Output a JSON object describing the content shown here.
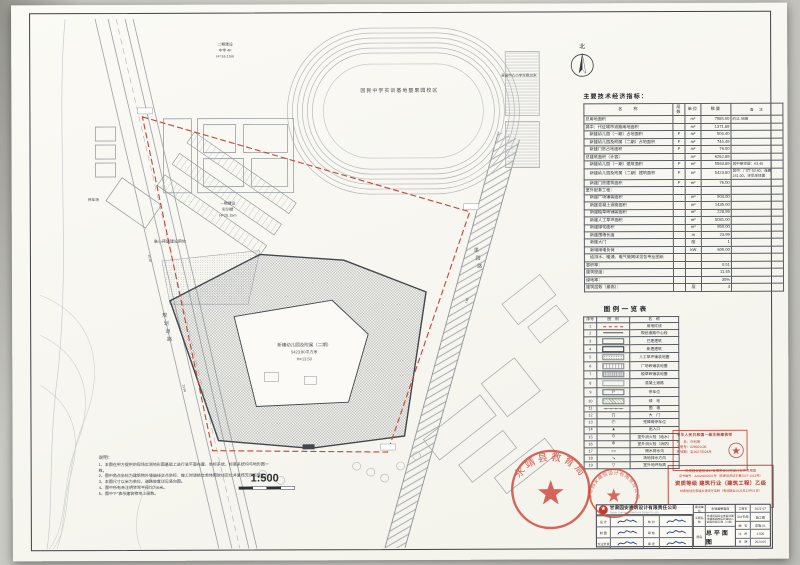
{
  "plan": {
    "north": "北",
    "scale": "1:500",
    "track_label": "回民中学实训基地暨果园校区",
    "school_note": "景园中心小学东侧20米",
    "phase_top": [
      "二期建设",
      "中学 4F",
      "H=16.15m"
    ],
    "phase_left": [
      "一期建设",
      "实训楼",
      "H=20.15m"
    ],
    "reserved": "高小预留建设用地",
    "parking_label": "停车场",
    "road_left": "规划道路",
    "road_right": "果园路",
    "building_label": [
      "新建幼儿园及附属（二期）",
      "5423.80平方米",
      "H=13.50"
    ],
    "dims": [
      "15.00",
      "23.99",
      "7.00"
    ],
    "notes_title": "说明：",
    "notes": [
      "本图在甲方提供的现场实测地形图基础上进行总平面布置，坐标系统、标高系统均与地形图一致。",
      "图中角点坐标为建筑物外墙轴线交点坐标，施工时请结合单体图放线定位并复核无误后施工。",
      "本图尺寸以米为单位，道路坡度详见竖向图。",
      "图中所有未注明转弯半径均为6米。",
      "图中\"F\"表示建筑物地上层数。"
    ]
  },
  "indicators": {
    "title": "主要技术经济指标：",
    "headers": [
      "名　　称",
      "层数",
      "单位",
      "数量",
      "备　注"
    ],
    "rows": [
      [
        "总用地面积",
        "",
        "m²",
        "7985.00",
        "约11.98亩"
      ],
      [
        "其中：代征城市道路用地面积",
        "",
        "m²",
        "1371.89",
        ""
      ],
      [
        "　新建幼儿园（一期）占地面积",
        "F",
        "m²",
        "504.40",
        ""
      ],
      [
        "　新建幼儿园及附属（二期）占地面积",
        "F",
        "m²",
        "744.49",
        ""
      ],
      [
        "　新建门房占地面积",
        "F",
        "m²",
        "76.00",
        ""
      ],
      [
        "总建筑面积（计容）",
        "",
        "m²",
        "6262.89",
        ""
      ],
      [
        "　新建幼儿园（一期）建筑面积",
        "F",
        "m²",
        "5563.89",
        "其中架空层：63.40"
      ],
      [
        "　新建幼儿园及附属（二期）建筑面积",
        "F",
        "m²",
        "5423.80",
        "其中：门厅 63.40、连廊 241.00，详见单体图"
      ],
      [
        "　新建门房建筑面积",
        "F",
        "m²",
        "76.00",
        ""
      ],
      [
        "室外配套工程：",
        "",
        "",
        "",
        ""
      ],
      [
        "　新建广场铺装面积",
        "",
        "m²",
        "904.00",
        ""
      ],
      [
        "　新建混凝土道路面积",
        "",
        "m²",
        "1435.00",
        ""
      ],
      [
        "　新建植草砖铺装面积",
        "",
        "m²",
        "228.99",
        ""
      ],
      [
        "　新建人工草坪面积",
        "",
        "m²",
        "5081.00",
        ""
      ],
      [
        "　新建绿化面积",
        "",
        "m²",
        "950.00",
        ""
      ],
      [
        "　新建围墙长度",
        "",
        "m",
        "23.99",
        ""
      ],
      [
        "　新建大门",
        "",
        "座",
        "1",
        ""
      ],
      [
        "　新增用电负荷",
        "",
        "kW",
        "600.00",
        ""
      ],
      [
        "　给排水、暖通、电气管网详见各专业图纸",
        "",
        "",
        "",
        ""
      ],
      [
        "容积率：",
        "",
        "",
        "0.51",
        ""
      ],
      [
        "建筑密度：",
        "",
        "",
        "11.45",
        ""
      ],
      [
        "绿地率：",
        "",
        "",
        "35%",
        ""
      ],
      [
        "建筑层数（最高）：",
        "",
        "层",
        "4",
        ""
      ]
    ]
  },
  "legend": {
    "title": "图例一览表",
    "headers": [
      "序号",
      "图　例",
      "名　称"
    ],
    "rows": [
      {
        "no": "1",
        "sym": "redline",
        "glyph": "",
        "name": "用地红线"
      },
      {
        "no": "2",
        "sym": "centerline",
        "glyph": "",
        "name": "规划道路中心线"
      },
      {
        "no": "3",
        "sym": "rect",
        "glyph": "",
        "name": "已建建筑"
      },
      {
        "no": "4",
        "sym": "rectbold",
        "glyph": "",
        "name": "新建建筑"
      },
      {
        "no": "5",
        "sym": "dots",
        "glyph": "",
        "name": "人工草坪铺装地面"
      },
      {
        "no": "6",
        "sym": "grid",
        "glyph": "",
        "name": "广场砖铺装地面"
      },
      {
        "no": "7",
        "sym": "gridg",
        "glyph": "",
        "name": "植草砖铺装地面"
      },
      {
        "no": "8",
        "sym": "plainrect",
        "glyph": "",
        "name": "混凝土道路"
      },
      {
        "no": "9",
        "sym": "prect",
        "glyph": "P",
        "name": "停车位"
      },
      {
        "no": "10",
        "sym": "hatch",
        "glyph": "",
        "name": "绿　地"
      },
      {
        "no": "11",
        "sym": "wall",
        "glyph": "",
        "name": "围　墙"
      },
      {
        "no": "12",
        "sym": "glyphonly",
        "glyph": "∏",
        "name": "大　门"
      },
      {
        "no": "13",
        "sym": "glyphonly",
        "glyph": "Ⓟ",
        "name": "无障碍停车位"
      },
      {
        "no": "14",
        "sym": "glyphonly",
        "glyph": "▲",
        "name": "出入口"
      },
      {
        "no": "15",
        "sym": "glyphonly",
        "glyph": "⊙",
        "name": "室外消火栓（给水）"
      },
      {
        "no": "16",
        "sym": "glyphonly",
        "glyph": "⊗",
        "name": "室外消火栓（消防）"
      },
      {
        "no": "17",
        "sym": "glyphonly",
        "glyph": "≈≈",
        "name": "雨水排水沟"
      },
      {
        "no": "18",
        "sym": "glyphonly",
        "glyph": "↘",
        "name": "场地排水方向"
      },
      {
        "no": "19",
        "sym": "glyphonly",
        "glyph": "▽",
        "name": "室外地坪标高"
      }
    ]
  },
  "stamps": {
    "architect": {
      "title": "中华人民共和国一级注册建筑师",
      "name_label": "姓　名：",
      "name": "许利明",
      "reg_label": "注册号：",
      "reg": "628029-06",
      "valid_label": "有效期：",
      "valid": "至2027年04月"
    },
    "license": {
      "l1": "甘肃园安建筑设计有限责任公司设计文件专用章",
      "l2": "证书编号：A2620062001号（甘建设资证字第2027-1013号）",
      "l3": "资质等级 建筑行业（建筑工程）乙级",
      "l4": "甘肃省住房和城乡建设厅监制（有效期至2025年12月31日）"
    }
  },
  "seals": {
    "bureau": "永靖县教育局",
    "company": "甘肃园安建筑设计有限责任公司"
  },
  "titleblock": {
    "company_cn": "甘肃园安建筑设计有限责任公司",
    "company_en": "Gansu Yuan'an Architectural Design Co.,Ltd",
    "owner_label": "建设单位",
    "owner": "永靖县教育局",
    "project_label": "工程名称",
    "project_name": "永靖县回民中学实训基地暨果园校区新建幼儿园及附属工程（二期）",
    "drawing_label": "图名",
    "drawing_name": "总平面图",
    "sign_labels": [
      "设 计",
      "校 对",
      "制 图",
      "审 核",
      "专业负责",
      "审 定"
    ],
    "fields": [
      [
        "工程号",
        "2021-07"
      ],
      [
        "设计阶段",
        "施工图"
      ],
      [
        "图　号",
        "总施-01"
      ],
      [
        "比　例",
        "1:500"
      ],
      [
        "日　期",
        "2024.05"
      ]
    ]
  }
}
